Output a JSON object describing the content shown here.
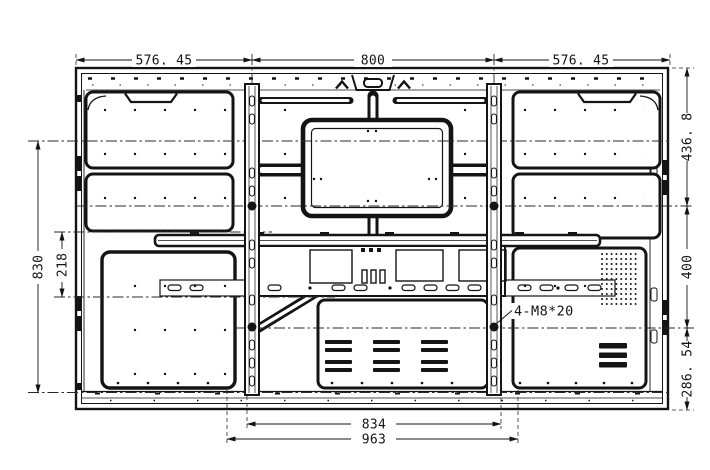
{
  "drawing": {
    "type": "rear-panel-dimension-drawing",
    "colors": {
      "line": "#141414",
      "background": "#ffffff"
    },
    "dims": {
      "top_left": "576. 45",
      "top_center": "800",
      "top_right": "576. 45",
      "right_top": "436. 8",
      "right_middle": "400",
      "right_bottom": "286. 54",
      "left_outer": "830",
      "left_inner": "218",
      "bottom_inner": "834",
      "bottom_outer": "963",
      "mount_note": "4-M8*20"
    }
  }
}
